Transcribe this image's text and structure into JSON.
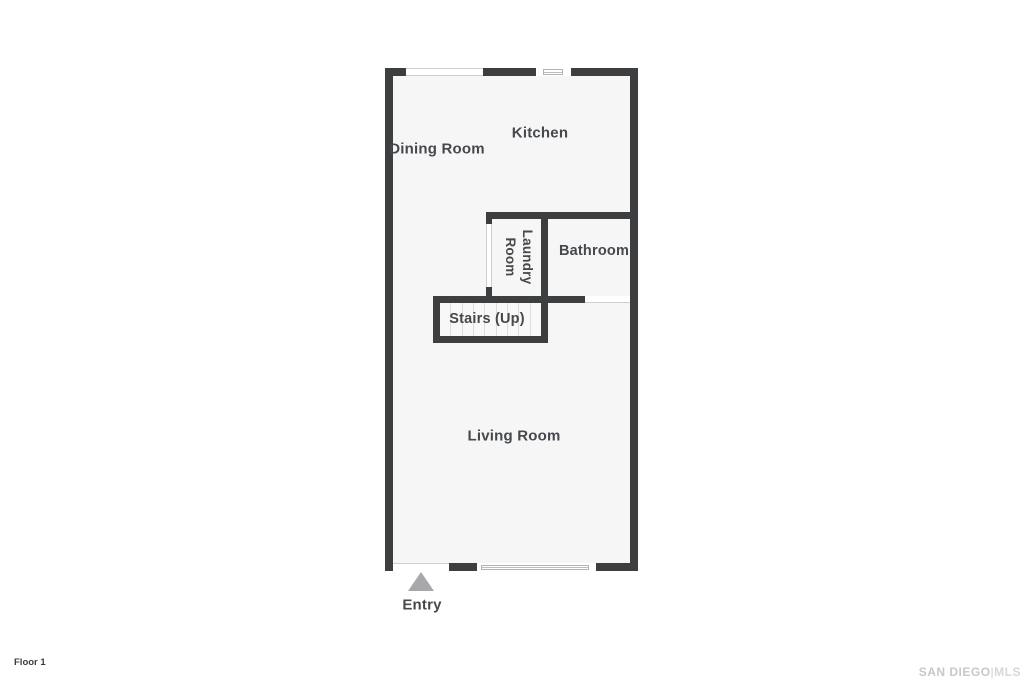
{
  "floorplan": {
    "floor_label": "Floor 1",
    "rooms": {
      "kitchen": "Kitchen",
      "dining_room": "Dining Room",
      "laundry_room": "Laundry Room",
      "bathroom": "Bathroom",
      "stairs": "Stairs (Up)",
      "living_room": "Living Room"
    },
    "entry_label": "Entry",
    "watermark": {
      "left": "SAN DIEGO",
      "divider": "|",
      "right": "MLS"
    },
    "colors": {
      "wall": "#3d3e40",
      "floor": "#f6f6f6",
      "label_text": "#45484c",
      "entry_arrow": "#a8a8ab",
      "stair_tread_line": "#dcdcdc",
      "opening_line": "#cfcfcf",
      "watermark_text": "#c8c8ca"
    }
  }
}
